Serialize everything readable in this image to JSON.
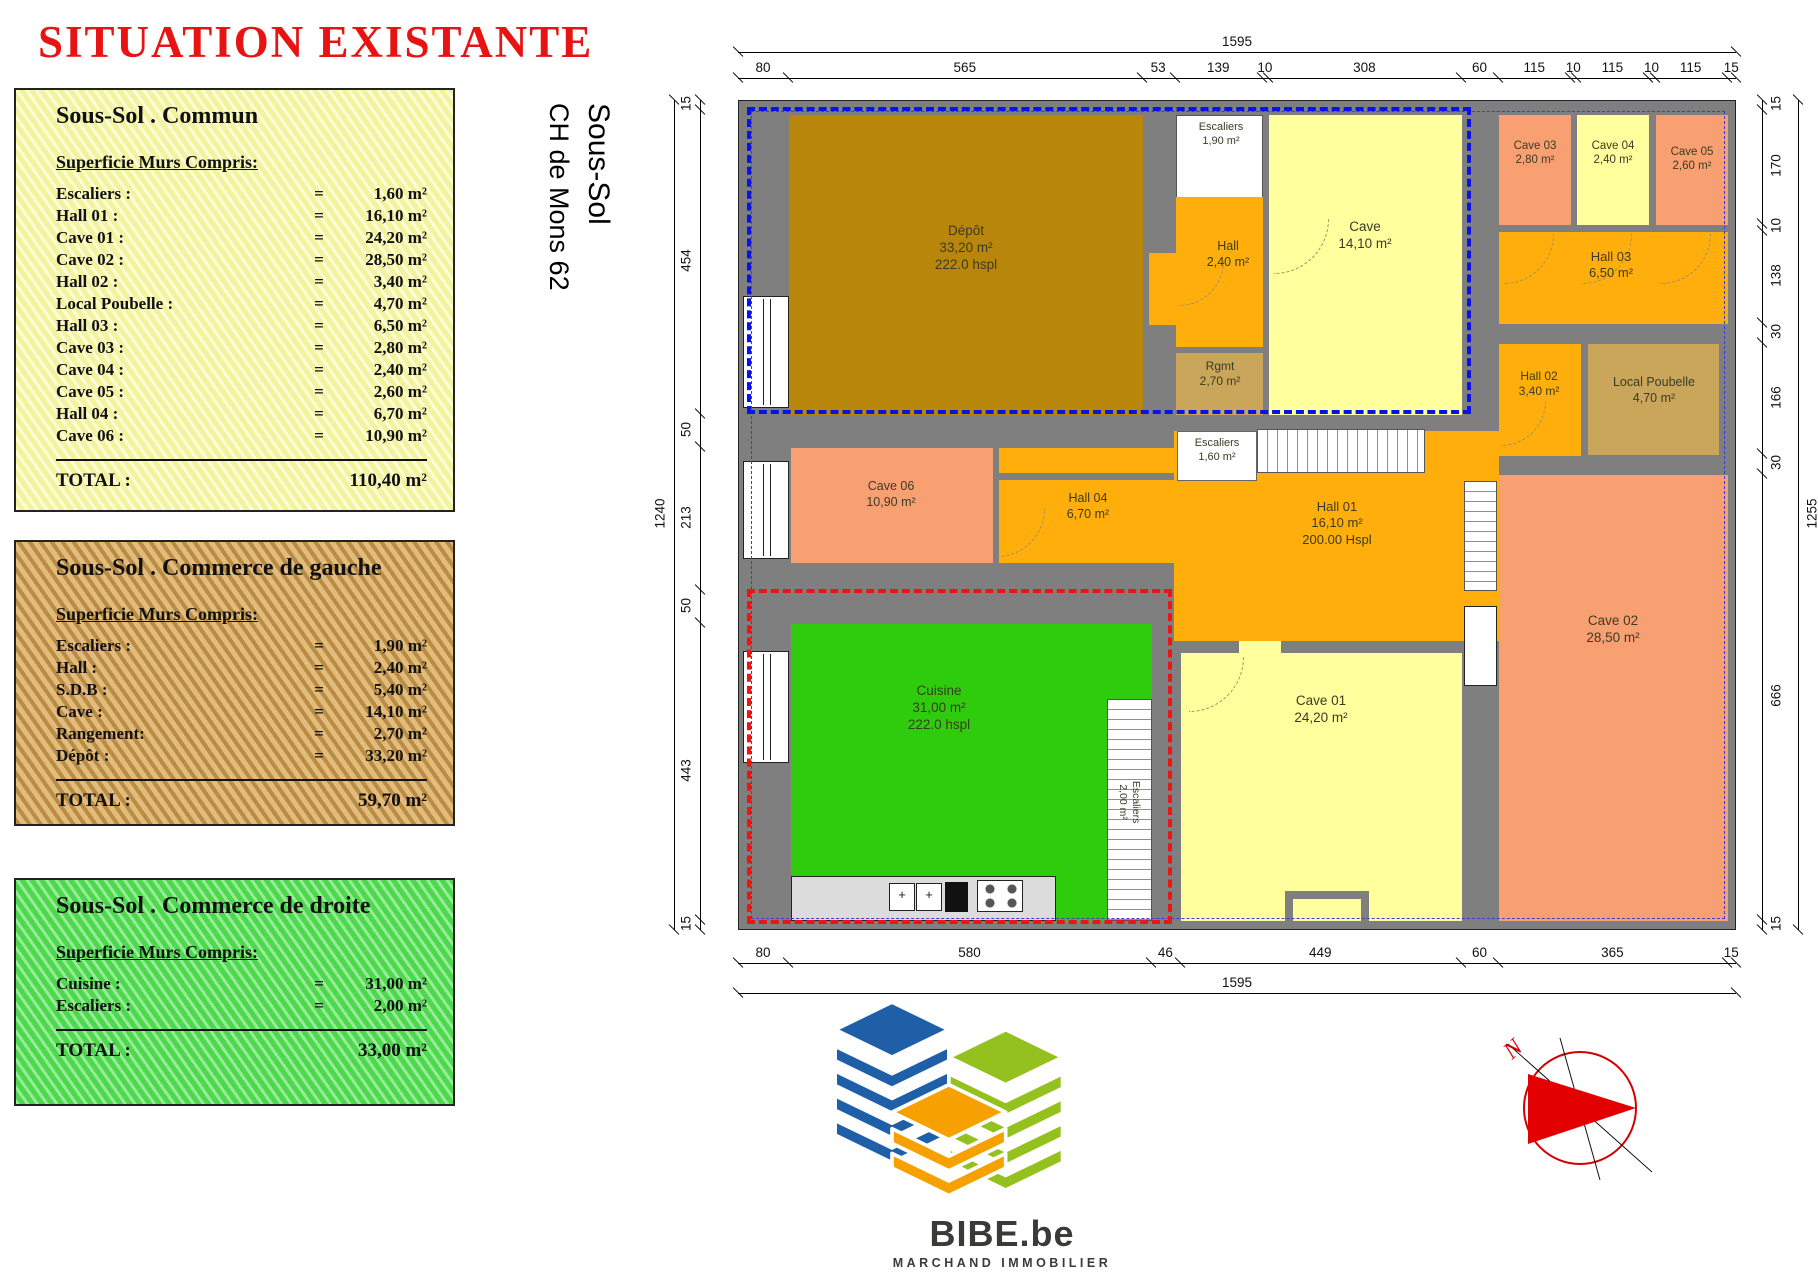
{
  "title": "SITUATION EXISTANTE",
  "side_label": {
    "line1": "Sous-Sol",
    "line2": "CH de Mons 62"
  },
  "panels": [
    {
      "theme": "yellow",
      "top": 88,
      "height": 424,
      "title": "Sous-Sol . Commun",
      "subtitle": "Superficie Murs Compris:",
      "rows": [
        {
          "label": "Escaliers :",
          "eq": "=",
          "value": "1,60 m²"
        },
        {
          "label": "Hall 01 :",
          "eq": "=",
          "value": "16,10 m²"
        },
        {
          "label": "Cave 01 :",
          "eq": "=",
          "value": "24,20 m²"
        },
        {
          "label": "Cave 02 :",
          "eq": "=",
          "value": "28,50 m²"
        },
        {
          "label": "Hall 02 :",
          "eq": "=",
          "value": "3,40 m²"
        },
        {
          "label": "Local Poubelle :",
          "eq": "=",
          "value": "4,70 m²"
        },
        {
          "label": "Hall 03 :",
          "eq": "=",
          "value": "6,50 m²"
        },
        {
          "label": "Cave 03 :",
          "eq": "=",
          "value": "2,80 m²"
        },
        {
          "label": "Cave 04 :",
          "eq": "=",
          "value": "2,40 m²"
        },
        {
          "label": "Cave 05 :",
          "eq": "=",
          "value": "2,60 m²"
        },
        {
          "label": "Hall 04 :",
          "eq": "=",
          "value": "6,70 m²"
        },
        {
          "label": "Cave 06 :",
          "eq": "=",
          "value": "10,90 m²"
        }
      ],
      "total_label": "TOTAL :",
      "total_value": "110,40 m²"
    },
    {
      "theme": "wood",
      "top": 540,
      "height": 286,
      "title": "Sous-Sol . Commerce de gauche",
      "subtitle": "Superficie Murs Compris:",
      "rows": [
        {
          "label": "Escaliers :",
          "eq": "=",
          "value": "1,90 m²"
        },
        {
          "label": "Hall :",
          "eq": "=",
          "value": "2,40 m²"
        },
        {
          "label": "S.D.B :",
          "eq": "=",
          "value": "5,40 m²"
        },
        {
          "label": "Cave :",
          "eq": "=",
          "value": "14,10 m²"
        },
        {
          "label": "Rangement:",
          "eq": "=",
          "value": "2,70 m²"
        },
        {
          "label": "Dépôt :",
          "eq": "=",
          "value": "33,20 m²"
        }
      ],
      "total_label": "TOTAL :",
      "total_value": "59,70 m²"
    },
    {
      "theme": "green",
      "top": 878,
      "height": 228,
      "title": "Sous-Sol . Commerce de droite",
      "subtitle": "Superficie Murs Compris:",
      "rows": [
        {
          "label": "Cuisine :",
          "eq": "=",
          "value": "31,00 m²"
        },
        {
          "label": "Escaliers :",
          "eq": "=",
          "value": "2,00 m²"
        }
      ],
      "total_label": "TOTAL :",
      "total_value": "33,00 m²"
    }
  ],
  "plan": {
    "wall_color": "#7F7F7F",
    "dims": {
      "top": [
        "80",
        "565",
        "53",
        "139",
        "10",
        "308",
        "60",
        "115",
        "10",
        "115",
        "10",
        "115",
        "15"
      ],
      "top_overall": [
        "1595"
      ],
      "bottom": [
        "80",
        "580",
        "46",
        "449",
        "60",
        "365",
        "15"
      ],
      "bottom_overall": [
        "1595"
      ],
      "left": [
        "15",
        "454",
        "50",
        "213",
        "50",
        "443",
        "15"
      ],
      "left_overall": [
        "1240"
      ],
      "right": [
        "15",
        "170",
        "10",
        "138",
        "30",
        "166",
        "30",
        "666",
        "15"
      ],
      "right_overall": [
        "1255"
      ]
    },
    "rooms": [
      {
        "id": "depot",
        "x": 50,
        "y": 14,
        "w": 354,
        "h": 300,
        "color": "#B8860B",
        "cx": 227,
        "cy": 122,
        "fs": 13.5,
        "lines": [
          "Dépôt",
          "33,20 m²",
          "222.0 hspl"
        ]
      },
      {
        "id": "escaliers-haut",
        "x": 437,
        "y": 14,
        "w": 87,
        "h": 96,
        "color": "#FFFFFF",
        "cls": "stairs-h",
        "cx": 482,
        "cy": 20,
        "fs": 11,
        "lines": [
          "Escaliers",
          "1,90 m²"
        ]
      },
      {
        "id": "hall",
        "x": 437,
        "y": 96,
        "w": 87,
        "h": 150,
        "color": "#FFAE0B",
        "cx": 489,
        "cy": 138,
        "fs": 12.5,
        "lines": [
          "Hall",
          "2,40 m²"
        ]
      },
      {
        "id": "rgmt",
        "x": 437,
        "y": 252,
        "w": 87,
        "h": 62,
        "color": "#C9A65A",
        "cx": 481,
        "cy": 258,
        "fs": 12,
        "lines": [
          "Rgmt",
          "2,70 m²"
        ]
      },
      {
        "id": "cave",
        "x": 530,
        "y": 14,
        "w": 193,
        "h": 300,
        "color": "#FFFF9E",
        "cx": 626,
        "cy": 118,
        "fs": 13.5,
        "lines": [
          "Cave",
          "14,10 m²"
        ]
      },
      {
        "id": "cave03",
        "x": 760,
        "y": 14,
        "w": 72,
        "h": 110,
        "color": "#F8A071",
        "cx": 796,
        "cy": 38,
        "fs": 11.5,
        "lines": [
          "Cave 03",
          "2,80 m²"
        ]
      },
      {
        "id": "cave04",
        "x": 838,
        "y": 14,
        "w": 72,
        "h": 110,
        "color": "#FFFF9E",
        "cx": 874,
        "cy": 38,
        "fs": 11.5,
        "lines": [
          "Cave 04",
          "2,40 m²"
        ]
      },
      {
        "id": "cave05",
        "x": 917,
        "y": 14,
        "w": 72,
        "h": 110,
        "color": "#F8A071",
        "cx": 953,
        "cy": 44,
        "fs": 11.5,
        "lines": [
          "Cave 05",
          "2,60 m²"
        ]
      },
      {
        "id": "hall03",
        "x": 760,
        "y": 131,
        "w": 229,
        "h": 92,
        "color": "#FFAE0B",
        "cx": 872,
        "cy": 148,
        "fs": 13,
        "lines": [
          "Hall 03",
          "6,50 m²"
        ]
      },
      {
        "id": "hall02",
        "x": 760,
        "y": 243,
        "w": 82,
        "h": 112,
        "color": "#FFAE0B",
        "cx": 800,
        "cy": 268,
        "fs": 12,
        "lines": [
          "Hall 02",
          "3,40 m²"
        ]
      },
      {
        "id": "local-poubelle",
        "x": 849,
        "y": 243,
        "w": 131,
        "h": 111,
        "color": "#C9A65A",
        "cx": 915,
        "cy": 274,
        "fs": 12.5,
        "lines": [
          "Local Poubelle",
          "4,70 m²"
        ]
      },
      {
        "id": "cave06",
        "x": 52,
        "y": 347,
        "w": 202,
        "h": 115,
        "color": "#F8A071",
        "cx": 152,
        "cy": 378,
        "fs": 12.5,
        "lines": [
          "Cave 06",
          "10,90 m²"
        ]
      },
      {
        "id": "hall04",
        "x": 260,
        "y": 347,
        "w": 175,
        "h": 115,
        "color": "#FFAE0B",
        "cx": 349,
        "cy": 390,
        "fs": 12.5,
        "lines": [
          "Hall 04",
          "6,70 m²"
        ]
      },
      {
        "id": "hall01",
        "x": 435,
        "y": 330,
        "w": 325,
        "h": 210,
        "color": "#FFAE0B",
        "cx": 598,
        "cy": 398,
        "fs": 13,
        "lines": [
          "Hall 01",
          "16,10 m²",
          "200.00 Hspl"
        ]
      },
      {
        "id": "cuisine",
        "x": 52,
        "y": 523,
        "w": 361,
        "h": 297,
        "color": "#2FCB0D",
        "cx": 200,
        "cy": 582,
        "fs": 13.5,
        "lines": [
          "Cuisine",
          "31,00 m²",
          "222.0 hspl"
        ]
      },
      {
        "id": "cave01",
        "x": 442,
        "y": 552,
        "w": 281,
        "h": 268,
        "color": "#FFFF9E",
        "cx": 582,
        "cy": 592,
        "fs": 13.5,
        "lines": [
          "Cave 01",
          "24,20 m²"
        ]
      },
      {
        "id": "cave02",
        "x": 760,
        "y": 374,
        "w": 229,
        "h": 446,
        "color": "#F8A071",
        "cx": 874,
        "cy": 512,
        "fs": 13.5,
        "lines": [
          "Cave 02",
          "28,50 m²"
        ]
      },
      {
        "id": "hall-niche",
        "x": 410,
        "y": 152,
        "w": 27,
        "h": 72,
        "color": "#FFAE0B"
      },
      {
        "id": "hall01-couloir",
        "x": 723,
        "y": 392,
        "w": 37,
        "h": 72,
        "color": "#FFAE0B"
      },
      {
        "id": "passage-cave01",
        "x": 500,
        "y": 540,
        "w": 42,
        "h": 14,
        "color": "#FFFF9E"
      }
    ],
    "labels": [
      {
        "id": "escaliers-milieu",
        "cx": 478,
        "cy": 336,
        "fs": 11,
        "lines": [
          "Escaliers",
          "1,60 m²"
        ]
      },
      {
        "id": "escaliers-cuisine",
        "cx": 390,
        "cy": 688,
        "fs": 10.5,
        "rot": 90,
        "lines": [
          "Escaliers",
          "2,00 m²"
        ]
      }
    ],
    "overlays": [
      {
        "id": "zone-commerce-gauche",
        "cls": "ov-blue-thick",
        "x": 8,
        "y": 6,
        "w": 724,
        "h": 307
      },
      {
        "id": "zone-commun",
        "cls": "ov-blue-thin",
        "x": 12,
        "y": 10,
        "w": 974,
        "h": 808
      },
      {
        "id": "zone-commerce-droite",
        "cls": "ov-red-thick",
        "x": 8,
        "y": 488,
        "w": 425,
        "h": 335
      }
    ]
  },
  "logo": {
    "text": "BIBE.be",
    "tagline": "MARCHAND IMMOBILIER",
    "blue": "#1F5FA8",
    "green": "#94C11E",
    "orange": "#F6A100"
  },
  "compass": {
    "letter": "N",
    "color": "#D40000"
  }
}
